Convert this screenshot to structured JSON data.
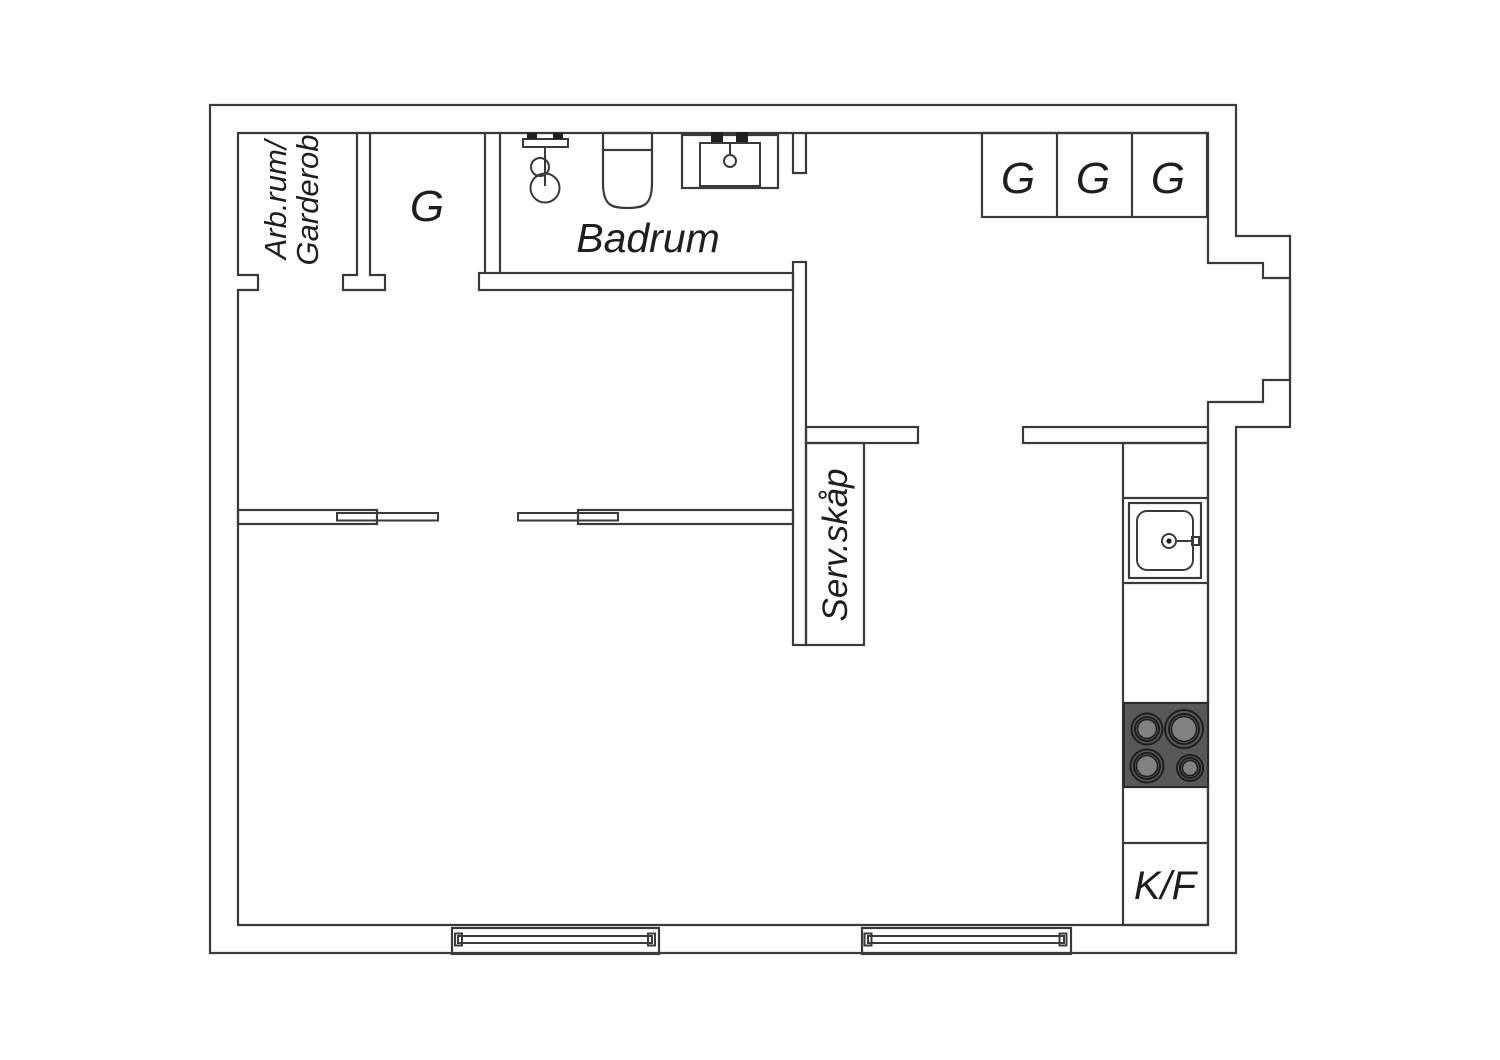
{
  "title": "Apartment floor plan",
  "colors": {
    "background": "#ffffff",
    "line": "#3a3a3a",
    "stove_fill": "#58585a",
    "burner_center_fill": "#808183",
    "burner_ring": "#1f1f1f"
  },
  "labels": {
    "workroom_line1": "Arb.rum/",
    "workroom_line2": "Garderob",
    "closet_topleft": "G",
    "bathroom": "Badrum",
    "closet_right_1": "G",
    "closet_right_2": "G",
    "closet_right_3": "G",
    "service_cabinet": "Serv.skåp",
    "fridge_freezer": "K/F"
  }
}
